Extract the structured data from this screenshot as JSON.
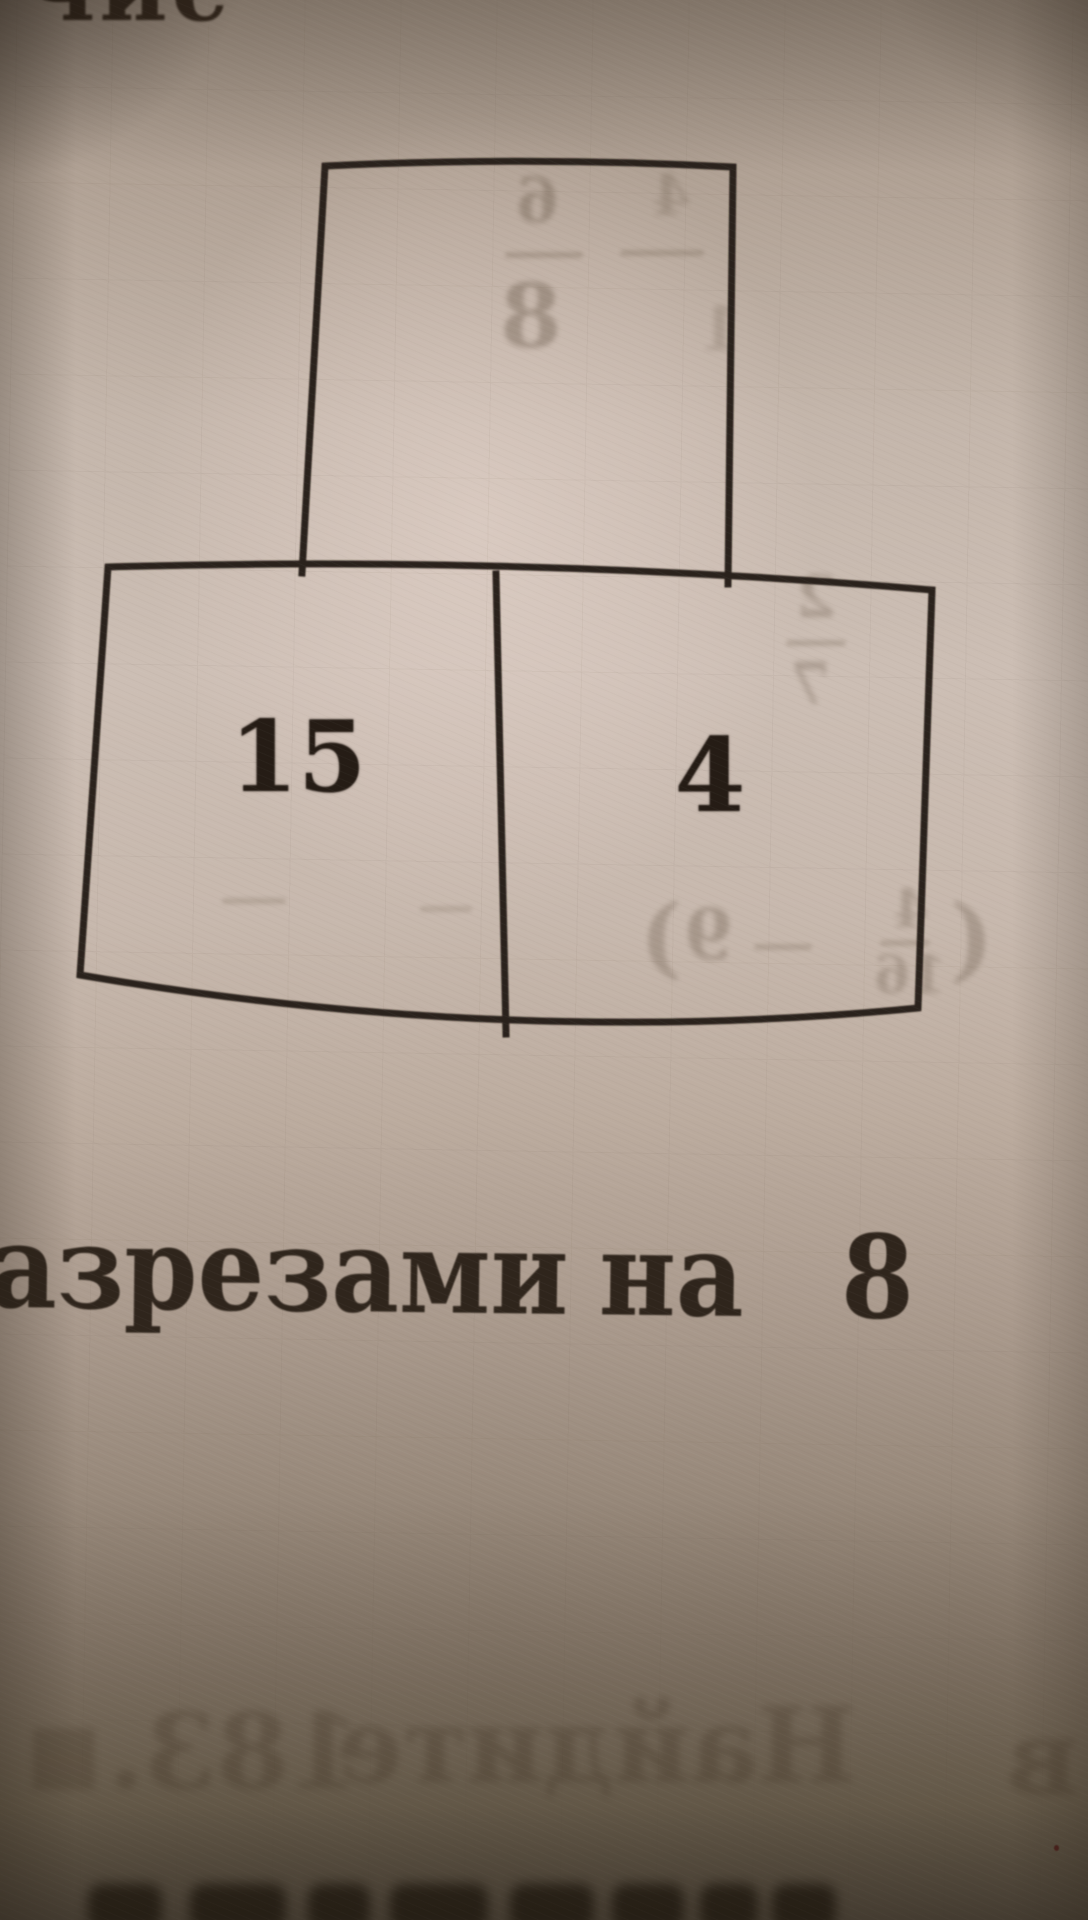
{
  "photo": {
    "top_partial_word": "чис",
    "diagram": {
      "top_box_value": "",
      "left_box_value": "15",
      "right_box_value": "4"
    },
    "caption": {
      "word1": "азрезами",
      "word2": "на",
      "word3": "8"
    }
  },
  "colors": {
    "ink": "#2a211a",
    "paper_light": "#ccbeb4",
    "paper_dark": "#645a4c",
    "ghost_ink": "#4a3b2a"
  },
  "ghosts": [
    {
      "type": "text",
      "text": "6",
      "x": 516,
      "y": 170,
      "size": 62,
      "o": 0.3
    },
    {
      "type": "bar",
      "x": 505,
      "y": 252,
      "w": 78,
      "o": 0.26
    },
    {
      "type": "text",
      "text": "8",
      "x": 500,
      "y": 272,
      "size": 88,
      "o": 0.33
    },
    {
      "type": "bar",
      "x": 620,
      "y": 250,
      "w": 84,
      "o": 0.24
    },
    {
      "type": "text",
      "text": "4",
      "x": 652,
      "y": 168,
      "size": 56,
      "o": 0.2
    },
    {
      "type": "text",
      "text": "1",
      "x": 700,
      "y": 300,
      "size": 60,
      "o": 0.18
    },
    {
      "type": "text",
      "text": "2",
      "x": 796,
      "y": 568,
      "size": 58,
      "o": 0.26
    },
    {
      "type": "bar",
      "x": 786,
      "y": 640,
      "w": 60,
      "o": 0.24
    },
    {
      "type": "text",
      "text": "7",
      "x": 790,
      "y": 655,
      "size": 58,
      "o": 0.26
    },
    {
      "type": "bar",
      "x": 222,
      "y": 898,
      "w": 64,
      "o": 0.2
    },
    {
      "type": "bar",
      "x": 420,
      "y": 906,
      "w": 52,
      "o": 0.18
    },
    {
      "type": "text",
      "text": ")",
      "x": 640,
      "y": 892,
      "size": 88,
      "o": 0.26
    },
    {
      "type": "text",
      "text": "9",
      "x": 684,
      "y": 900,
      "size": 70,
      "o": 0.28
    },
    {
      "type": "bar",
      "x": 754,
      "y": 944,
      "w": 58,
      "o": 0.22
    },
    {
      "type": "text",
      "text": "4",
      "x": 893,
      "y": 884,
      "size": 52,
      "o": 0.24
    },
    {
      "type": "bar",
      "x": 880,
      "y": 940,
      "w": 50,
      "o": 0.22
    },
    {
      "type": "text",
      "text": "16",
      "x": 874,
      "y": 950,
      "size": 52,
      "o": 0.24
    },
    {
      "type": "text",
      "text": "(",
      "x": 950,
      "y": 892,
      "size": 92,
      "o": 0.26
    }
  ],
  "ghost_line": [
    {
      "text": "■",
      "x": 26,
      "y": 1712,
      "size": 80,
      "o": 0.26
    },
    {
      "text": "183.",
      "x": 108,
      "y": 1700,
      "size": 104,
      "o": 0.28
    },
    {
      "text": "Найдите",
      "x": 336,
      "y": 1694,
      "size": 104,
      "o": 0.28
    },
    {
      "text": "в",
      "x": 1006,
      "y": 1706,
      "size": 104,
      "o": 0.28
    }
  ],
  "bottom_blobs": [
    {
      "x": 88,
      "w": 74
    },
    {
      "x": 190,
      "w": 96
    },
    {
      "x": 308,
      "w": 62
    },
    {
      "x": 390,
      "w": 98
    },
    {
      "x": 510,
      "w": 84
    },
    {
      "x": 612,
      "w": 72
    },
    {
      "x": 700,
      "w": 58
    },
    {
      "x": 772,
      "w": 64
    }
  ]
}
